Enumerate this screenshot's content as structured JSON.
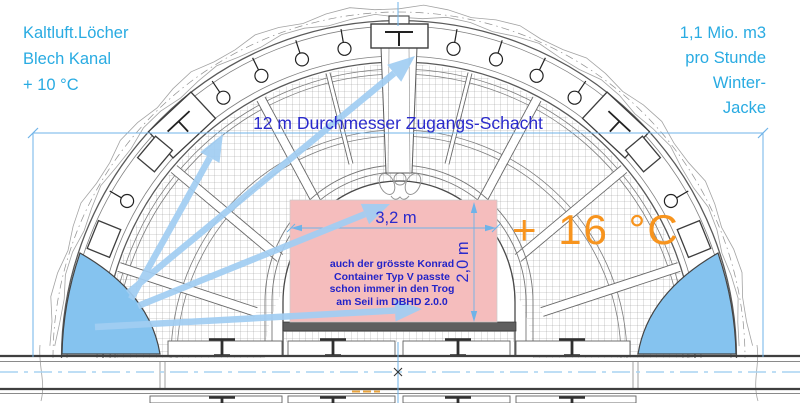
{
  "labels": {
    "top_left": {
      "line1": "Kaltluft.Löcher",
      "line2": "Blech Kanal",
      "line3": "+ 10 °C"
    },
    "top_right": {
      "line1": "1,1 Mio. m3",
      "line2": "pro Stunde",
      "line3": "Winter-",
      "line4": "Jacke"
    },
    "shaft_dimension": "12 m Durchmesser Zugangs-Schacht",
    "width_dimension": "3,2 m",
    "height_dimension": "2,0 m",
    "temperature_inside": "+ 16 °C",
    "container_note": {
      "line1": "auch der grösste Konrad",
      "line2": "Container Typ V passte",
      "line3": "schon immer in den Trog",
      "line4": "am Seil im DBHD 2.0.0"
    }
  },
  "colors": {
    "cyan_text": "#29ABE2",
    "blue_text": "#2A2ACC",
    "orange_text": "#F7941E",
    "container_pink": "#F5BDBD",
    "arrow_blue": "#A2CEF3",
    "water_blue": "#85C3EF",
    "dimension_blue": "#6FB3E8",
    "centerline_blue": "#A9D4F2"
  }
}
